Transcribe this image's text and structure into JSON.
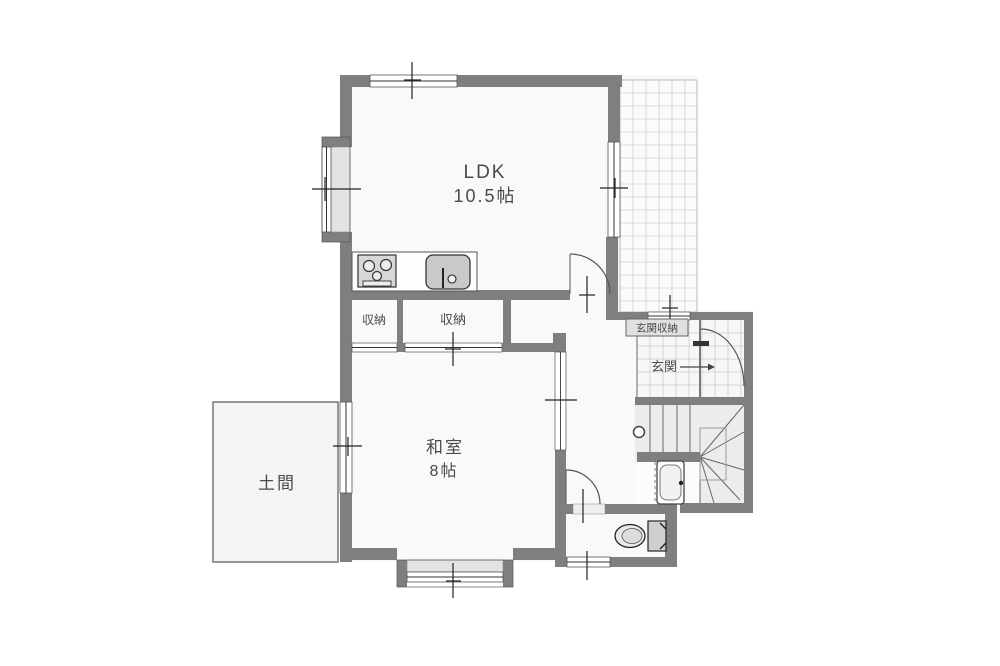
{
  "rooms": {
    "ldk": {
      "label": "LDK",
      "size": "10.5帖"
    },
    "washitsu": {
      "label": "和室",
      "size": "8帖"
    },
    "doma": {
      "label": "土間"
    },
    "closet_small": {
      "label": "収納"
    },
    "closet_large": {
      "label": "収納"
    },
    "genkan": {
      "label": "玄関"
    },
    "genkan_storage": {
      "label": "玄関収納"
    }
  },
  "colors": {
    "wall": "#7f7f7f",
    "floor": "#f9f9f9",
    "tile_floor": "#fbfbfb",
    "grid_line": "#d2d2d2",
    "sill": "#e3e3e3",
    "text": "#4a4a4a"
  }
}
